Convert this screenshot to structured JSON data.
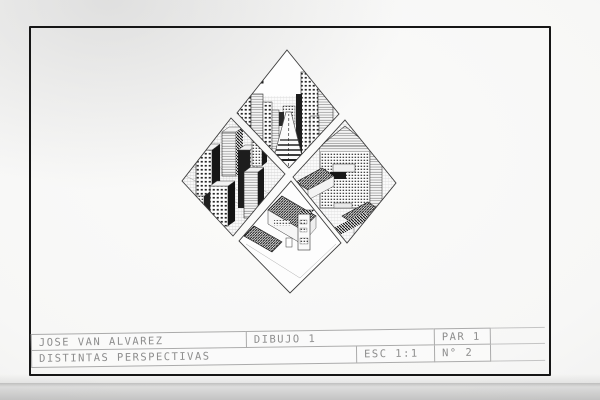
{
  "photo": {
    "background_color": "#d9d9d9",
    "paper_color": "#f8f8f6"
  },
  "sheet": {
    "border_color": "#161616",
    "pencil_color": "#ababab",
    "ink_color": "#1c1c1c"
  },
  "title_block": {
    "author": "JOSE VAN ALVAREZ",
    "subject": "DIBUJO 1",
    "group": "PAR 1",
    "title": "DISTINTAS PERSPECTIVAS",
    "scale": "ESC 1:1",
    "sheet_number": "N° 2"
  },
  "artwork": {
    "layout": "four-diamond-panels",
    "panels": [
      {
        "id": "top",
        "scene": "street-one-point-perspective-with-balloon"
      },
      {
        "id": "left",
        "scene": "skyscraper-blocks-birds-eye"
      },
      {
        "id": "right",
        "scene": "grand-building-facade-axonometric"
      },
      {
        "id": "bottom",
        "scene": "house-rooftops-birds-eye"
      }
    ]
  }
}
